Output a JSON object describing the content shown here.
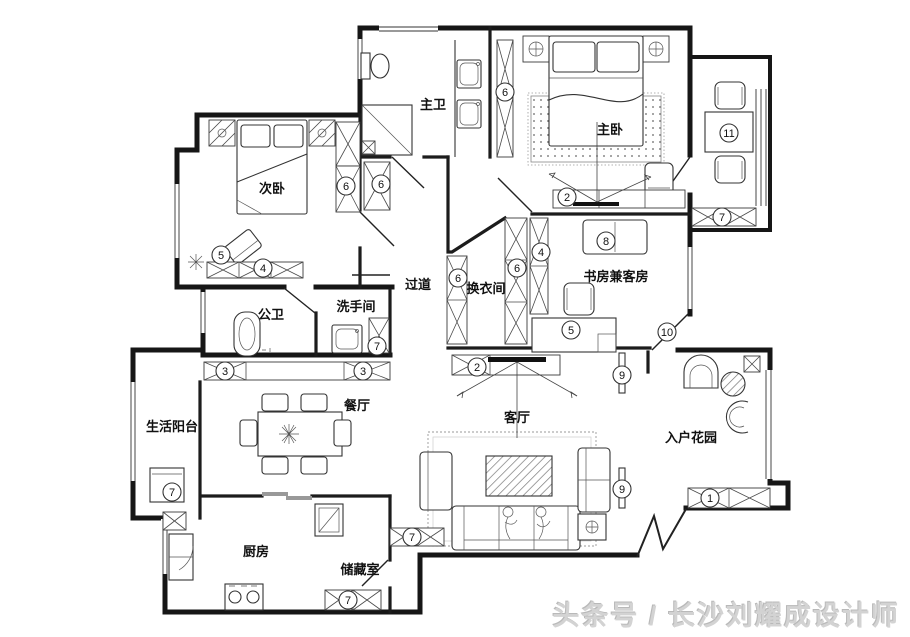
{
  "watermark": {
    "text": "头条号 / 长沙刘耀成设计师"
  },
  "colors": {
    "line": "#161616",
    "watermark": "#d3d3d3",
    "background": "#ffffff"
  },
  "floor_plan": {
    "rooms": [
      {
        "id": "zhu-wei",
        "label": "主卫",
        "x": 433,
        "y": 104
      },
      {
        "id": "zhu-wo",
        "label": "主卧",
        "x": 610,
        "y": 129
      },
      {
        "id": "ci-wo",
        "label": "次卧",
        "x": 272,
        "y": 188
      },
      {
        "id": "guo-dao",
        "label": "过道",
        "x": 418,
        "y": 284
      },
      {
        "id": "huan-yi-jian",
        "label": "换衣间",
        "x": 486,
        "y": 288
      },
      {
        "id": "shu-fang",
        "label": "书房兼客房",
        "x": 616,
        "y": 276
      },
      {
        "id": "gong-wei",
        "label": "公卫",
        "x": 271,
        "y": 314
      },
      {
        "id": "xi-shou-jian",
        "label": "洗手间",
        "x": 356,
        "y": 306
      },
      {
        "id": "sheng-huo-yang-tai",
        "label": "生活阳台",
        "x": 172,
        "y": 426
      },
      {
        "id": "can-ting",
        "label": "餐厅",
        "x": 357,
        "y": 405
      },
      {
        "id": "ke-ting",
        "label": "客厅",
        "x": 517,
        "y": 417
      },
      {
        "id": "ru-hu-hua-yuan",
        "label": "入户花园",
        "x": 691,
        "y": 437
      },
      {
        "id": "chu-fang",
        "label": "厨房",
        "x": 256,
        "y": 551
      },
      {
        "id": "chu-cang-shi",
        "label": "储藏室",
        "x": 360,
        "y": 569
      }
    ],
    "markers": [
      {
        "n": "6",
        "x": 346,
        "y": 186
      },
      {
        "n": "6",
        "x": 381,
        "y": 184
      },
      {
        "n": "6",
        "x": 505,
        "y": 92
      },
      {
        "n": "5",
        "x": 221,
        "y": 255
      },
      {
        "n": "4",
        "x": 263,
        "y": 268
      },
      {
        "n": "2",
        "x": 567,
        "y": 197
      },
      {
        "n": "11",
        "x": 729,
        "y": 133
      },
      {
        "n": "7",
        "x": 722,
        "y": 217
      },
      {
        "n": "6",
        "x": 458,
        "y": 278
      },
      {
        "n": "6",
        "x": 517,
        "y": 268
      },
      {
        "n": "4",
        "x": 541,
        "y": 252
      },
      {
        "n": "8",
        "x": 606,
        "y": 241
      },
      {
        "n": "5",
        "x": 571,
        "y": 330
      },
      {
        "n": "10",
        "x": 667,
        "y": 332
      },
      {
        "n": "2",
        "x": 477,
        "y": 367
      },
      {
        "n": "9",
        "x": 622,
        "y": 375
      },
      {
        "n": "9",
        "x": 622,
        "y": 489
      },
      {
        "n": "3",
        "x": 225,
        "y": 371
      },
      {
        "n": "3",
        "x": 363,
        "y": 371
      },
      {
        "n": "7",
        "x": 377,
        "y": 346
      },
      {
        "n": "7",
        "x": 172,
        "y": 492
      },
      {
        "n": "7",
        "x": 412,
        "y": 537
      },
      {
        "n": "7",
        "x": 348,
        "y": 600
      },
      {
        "n": "1",
        "x": 710,
        "y": 498
      }
    ]
  }
}
